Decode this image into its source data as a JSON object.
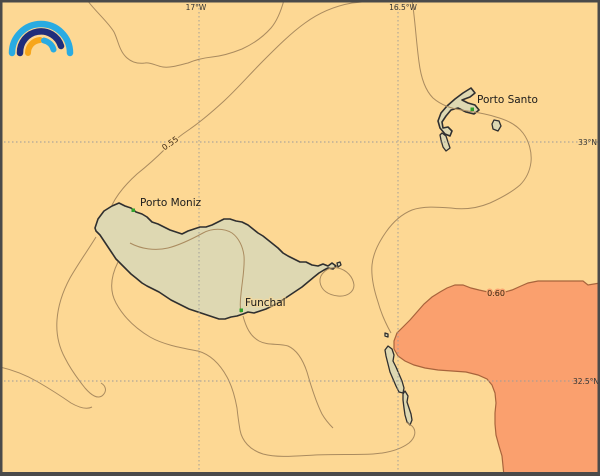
{
  "map": {
    "type": "geographic contour map of the Madeira archipelago",
    "grid": {
      "lon": [
        "17°W",
        "16.5°W"
      ],
      "lat": [
        "33°N",
        "32.5°N"
      ]
    },
    "contour_labels": {
      "c055": "0.55",
      "c060": "0.60"
    },
    "places": {
      "porto_moniz": "Porto Moniz",
      "funchal": "Funchal",
      "porto_santo": "Porto Santo"
    },
    "colors": {
      "sea_low_value": "#FDD894",
      "sea_high_value": "#FAA06E",
      "land": "#DED8B2",
      "coastline": "#2F2F2F",
      "contour_line": "#AA8B5F",
      "value_boundary_line": "#A8643C",
      "graticule": "#9A9A9A",
      "place_marker": "#2FA12B",
      "label_text": "#1B1B1B",
      "frame": "#4A4A4A",
      "logo_light_blue": "#29ABE2",
      "logo_navy": "#1F2D7B",
      "logo_orange": "#F7A61B"
    }
  }
}
